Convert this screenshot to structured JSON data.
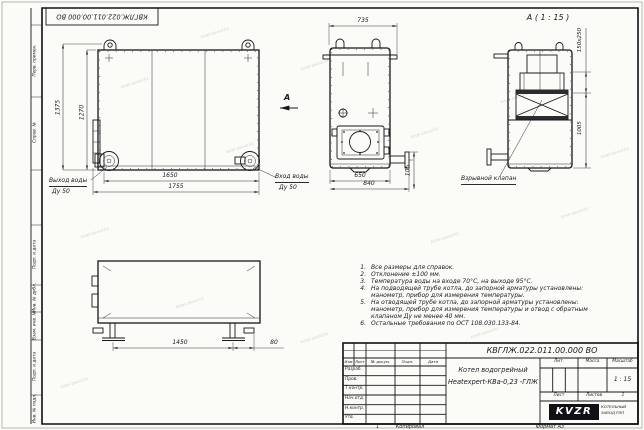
{
  "watermark": "kotel-zavod.kz",
  "stamp_top": "КВГЛЖ.022.011.00.000 ВО",
  "margin": {
    "labels": [
      "Перв. примен.",
      "Справ. №",
      "Подп. и дата",
      "Инв. № дубл.",
      "Взам. инв. №",
      "Подп. и дата",
      "Инв. № подл."
    ]
  },
  "front_view": {
    "dim_height_outer": "1375",
    "dim_height_inner": "1270",
    "dim_width_inner": "1650",
    "dim_width_outer": "1755",
    "outlet_label": "Выход воды",
    "outlet_dn": "Ду 50",
    "inlet_label": "Вход воды",
    "inlet_dn": "Ду 50",
    "section_mark": "А"
  },
  "side_view": {
    "dim_width_top": "735",
    "dim_width_inner": "650",
    "dim_width_outer": "840",
    "dim_pipe_height": "105"
  },
  "detail_view": {
    "title": "А ( 1 : 15 )",
    "dim_outlet": "150x250",
    "dim_height": "1005",
    "valve_label": "Взрывной клапан"
  },
  "top_view": {
    "dim_width": "1450",
    "dim_offset": "80"
  },
  "notes": {
    "items": [
      {
        "num": "1.",
        "text": "Все размеры для справок."
      },
      {
        "num": "2.",
        "text": "Отклонение ±100 мм."
      },
      {
        "num": "3.",
        "text": "Температура воды на входе 70°С, на выходе 95°С."
      },
      {
        "num": "4.",
        "text": "На подводящей трубе котла, до запорной арматуры установлены: манометр, прибор для измерения температуры."
      },
      {
        "num": "5.",
        "text": "На отводящей трубе котла, до запорной арматуры установлены: манометр, прибор для измерения температуры и отвод с обратным клапаном Ду не менее 40 мм."
      },
      {
        "num": "6.",
        "text": "Остальные требования по ОСТ 108.030.133-84."
      }
    ]
  },
  "titleblock": {
    "doc_number": "КВГЛЖ.022.011.00.000 ВО",
    "product_name_line1": "Котел водогрейный",
    "product_name_line2": "Heatexpert-КВа-0,23 -ГЛЖ",
    "col_izm": "Изм",
    "col_list": "Лист",
    "col_doc": "№ докум.",
    "col_podp": "Подп.",
    "col_data": "Дата",
    "rows": [
      "Разраб.",
      "Пров.",
      "Т.контр.",
      "Нач.отд.",
      "Н.контр.",
      "Утв."
    ],
    "lit_label": "Лит.",
    "mass_label": "Масса",
    "scale_label": "Масштаб",
    "scale_value": "1 : 15",
    "sheet_label": "Лист",
    "sheets_label": "Листов",
    "sheets_value": "1",
    "logo_text": "KVZR",
    "logo_sub1": "КОТЕЛЬНЫЙ",
    "logo_sub2": "ЗАВОД РЭП"
  },
  "footer": {
    "page_mark": "1",
    "kopiroval": "Копировал",
    "format": "Формат А3"
  }
}
